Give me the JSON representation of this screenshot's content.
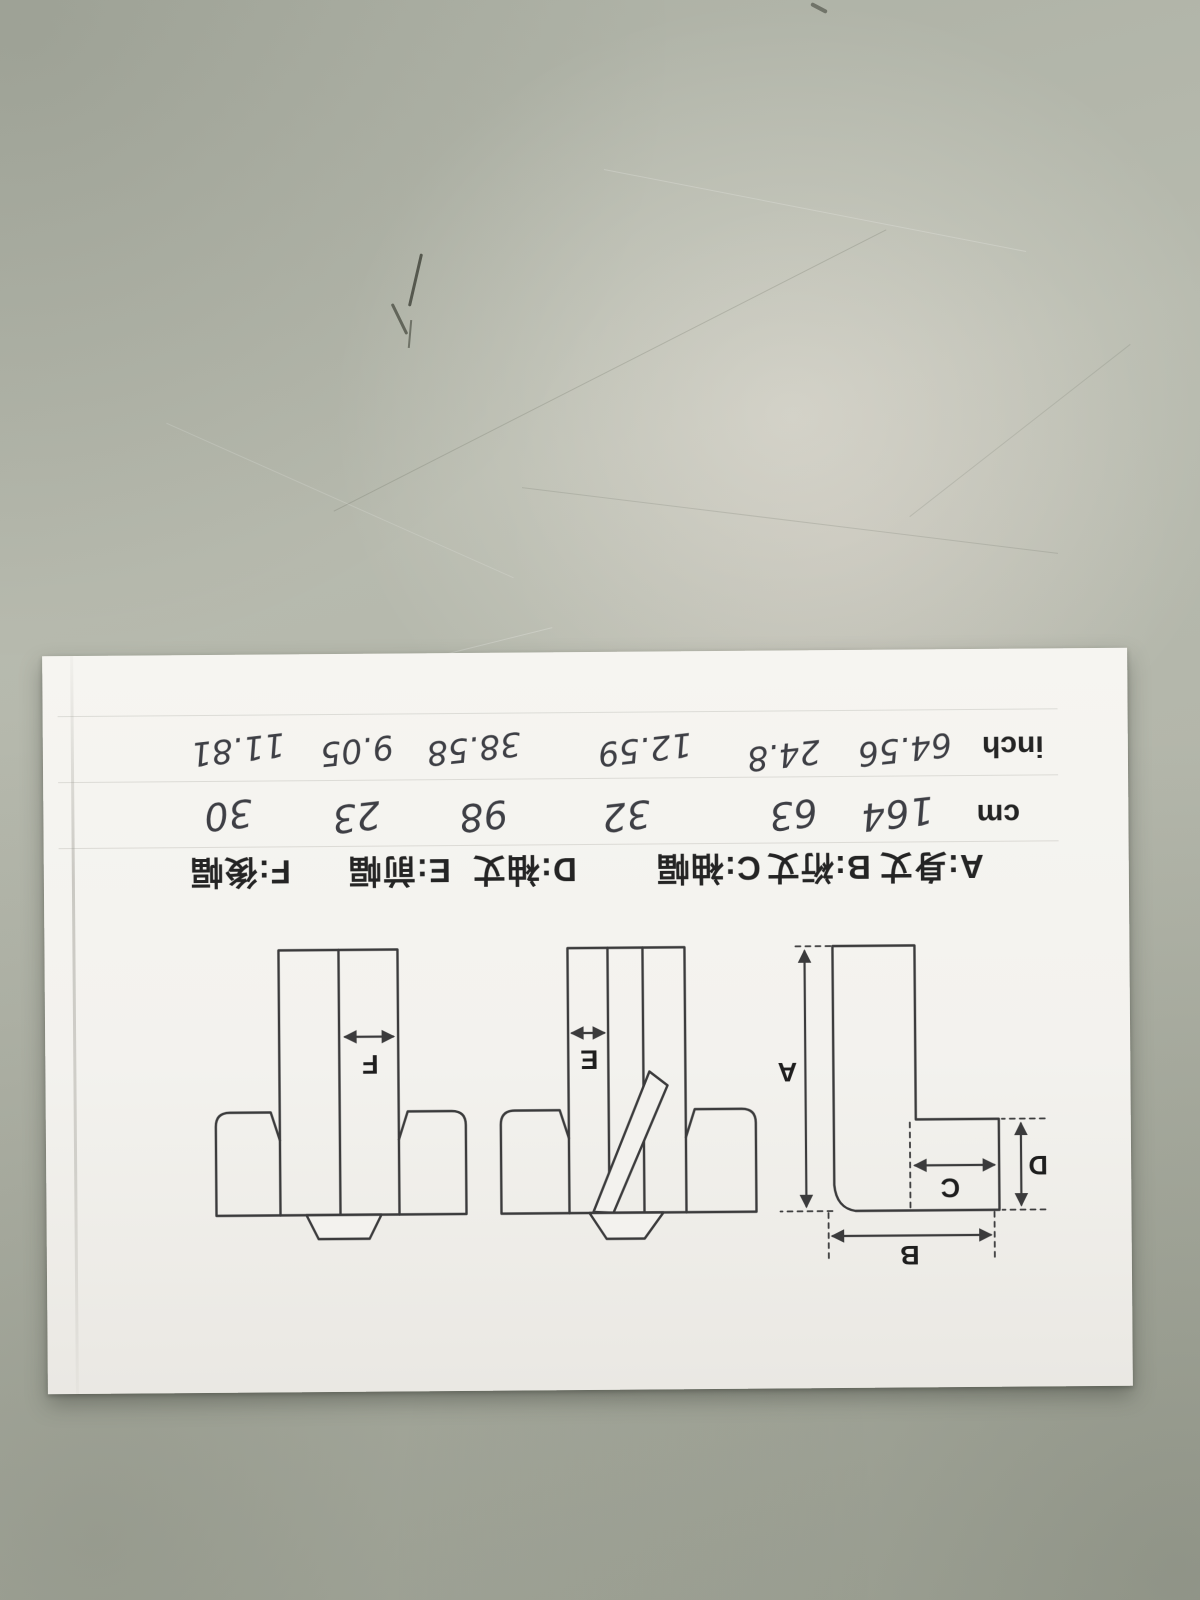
{
  "paper": {
    "row_headers": {
      "cm": "cm",
      "inch": "inch"
    },
    "measurements": [
      {
        "legend": "A:身丈",
        "letter": "A",
        "name": "身丈",
        "cm": "164",
        "inch": "64.56"
      },
      {
        "legend": "B:裄丈",
        "letter": "B",
        "name": "裄丈",
        "cm": "63",
        "inch": "24.8"
      },
      {
        "legend": "C:袖幅",
        "letter": "C",
        "name": "袖幅",
        "cm": "32",
        "inch": "12.59"
      },
      {
        "legend": "D:袖丈",
        "letter": "D",
        "name": "袖丈",
        "cm": "98",
        "inch": "38.58"
      },
      {
        "legend": "E:前幅",
        "letter": "E",
        "name": "前幅",
        "cm": "23",
        "inch": "9.05"
      },
      {
        "legend": "F:後幅",
        "letter": "F",
        "name": "後幅",
        "cm": "30",
        "inch": "11.81"
      }
    ],
    "colors": {
      "paper": "#f3f2ee",
      "table_surface": "#b2b5aa",
      "printed_ink": "#262626",
      "handwriting_ink": "#3e3f45",
      "diagram_line": "#3b3b3c"
    }
  }
}
